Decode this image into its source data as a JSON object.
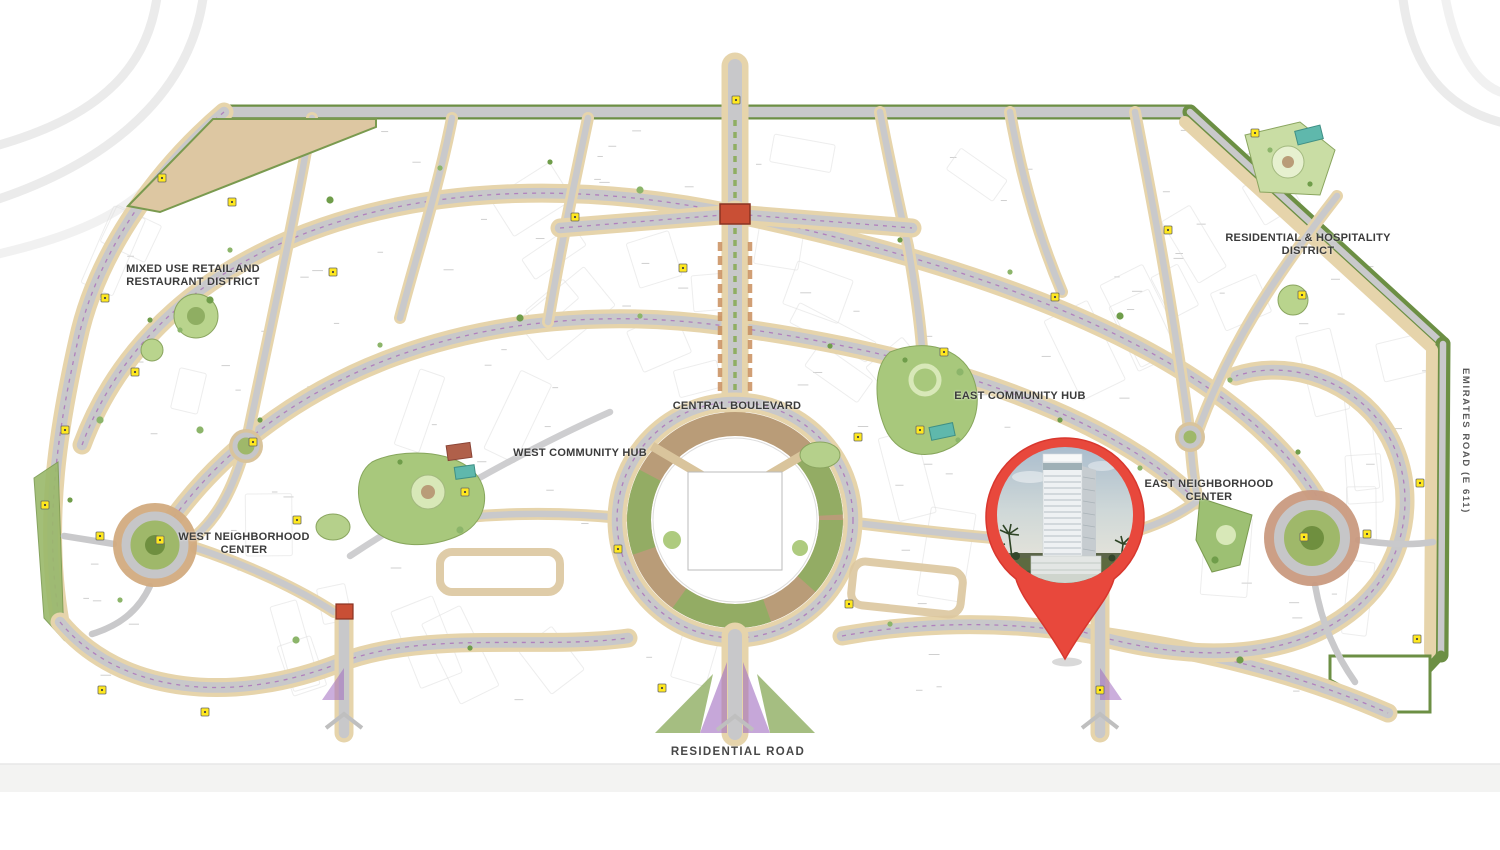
{
  "map": {
    "type": "community-master-plan",
    "labels": {
      "mixed_use_district": "MIXED USE RETAIL AND RESTAURANT DISTRICT",
      "central_boulevard": "CENTRAL BOULEVARD",
      "west_community_hub": "WEST COMMUNITY HUB",
      "east_community_hub": "EAST COMMUNITY HUB",
      "west_neighborhood_center": "WEST NEIGHBORHOOD CENTER",
      "east_neighborhood_center": "EAST NEIGHBORHOOD CENTER",
      "residential_hospitality_district": "RESIDENTIAL & HOSPITALITY DISTRICT",
      "residential_road": "RESIDENTIAL ROAD",
      "emirates_road": "EMIRATES ROAD (E 611)"
    },
    "pin": {
      "name": "location-pin",
      "color": "#E8483C",
      "content": "high-rise-tower-photo"
    },
    "colors": {
      "accent_red": "#E8483C",
      "road_gray": "#C8C8CA",
      "boundary_green": "#6C8F44",
      "sand": "#E6D4AB",
      "park_green": "#A8C87C",
      "marker_yellow": "#FFE81F",
      "utility_purple": "#A868B8"
    }
  }
}
